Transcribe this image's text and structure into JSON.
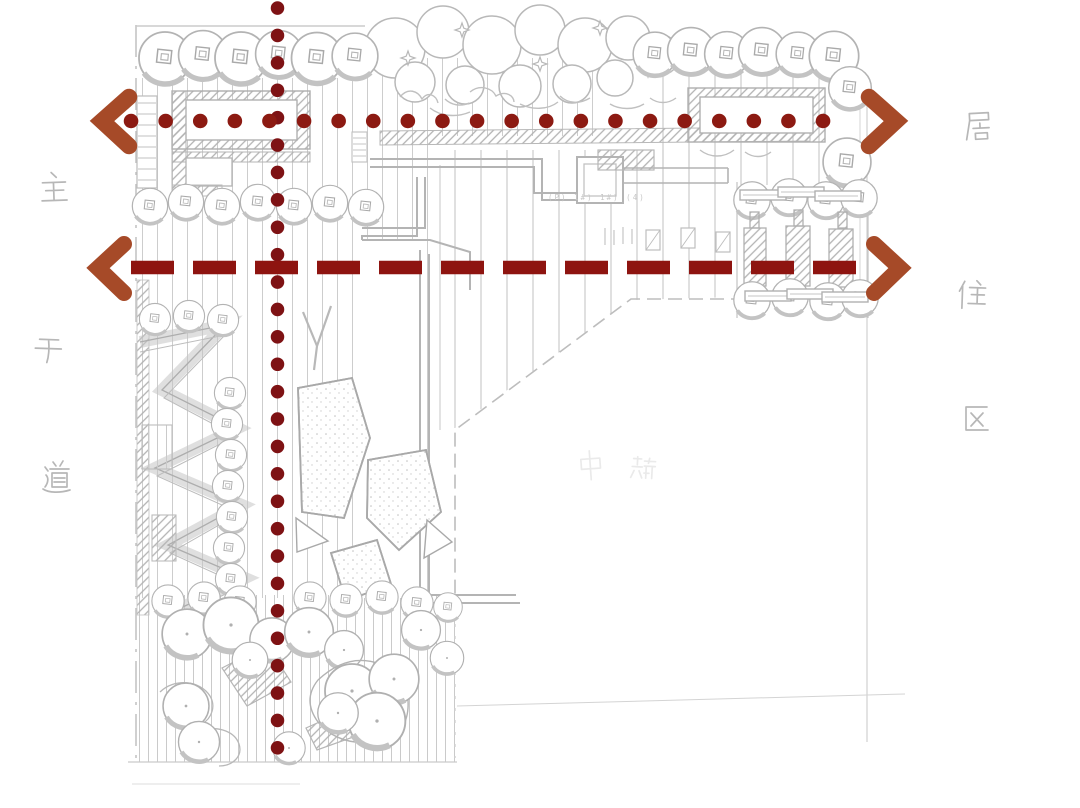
{
  "meta": {
    "description": "Hand-drawn residential landscape site plan sketch with red axis analysis overlay"
  },
  "labels": {
    "left_road": {
      "text": "主干道",
      "chars": [
        "主",
        "干",
        "道"
      ],
      "orientation": "vertical"
    },
    "right_district": {
      "text": "居住区",
      "chars": [
        "居",
        "住",
        "区"
      ],
      "orientation": "vertical"
    },
    "center_faint": {
      "text": "中端",
      "chars": [
        "中",
        "端"
      ]
    },
    "pencil_note": "(P)  1#)  1#)  (4)"
  },
  "axes": {
    "vertical_axis": {
      "style": "dotted",
      "color": "#7e1214",
      "orientation": "vertical"
    },
    "top_axis": {
      "style": "dotted",
      "color": "#8c1a12",
      "orientation": "horizontal",
      "arrow_both_ends": true
    },
    "middle_axis": {
      "style": "dashed",
      "color": "#8e1410",
      "orientation": "horizontal",
      "arrow_both_ends": true
    }
  },
  "colors": {
    "background": "#ffffff",
    "sketch_gray": "#b9b9b9",
    "arrow_rust": "#a64a28",
    "dot_red": "#8c1a12",
    "dash_red": "#8e1410"
  }
}
